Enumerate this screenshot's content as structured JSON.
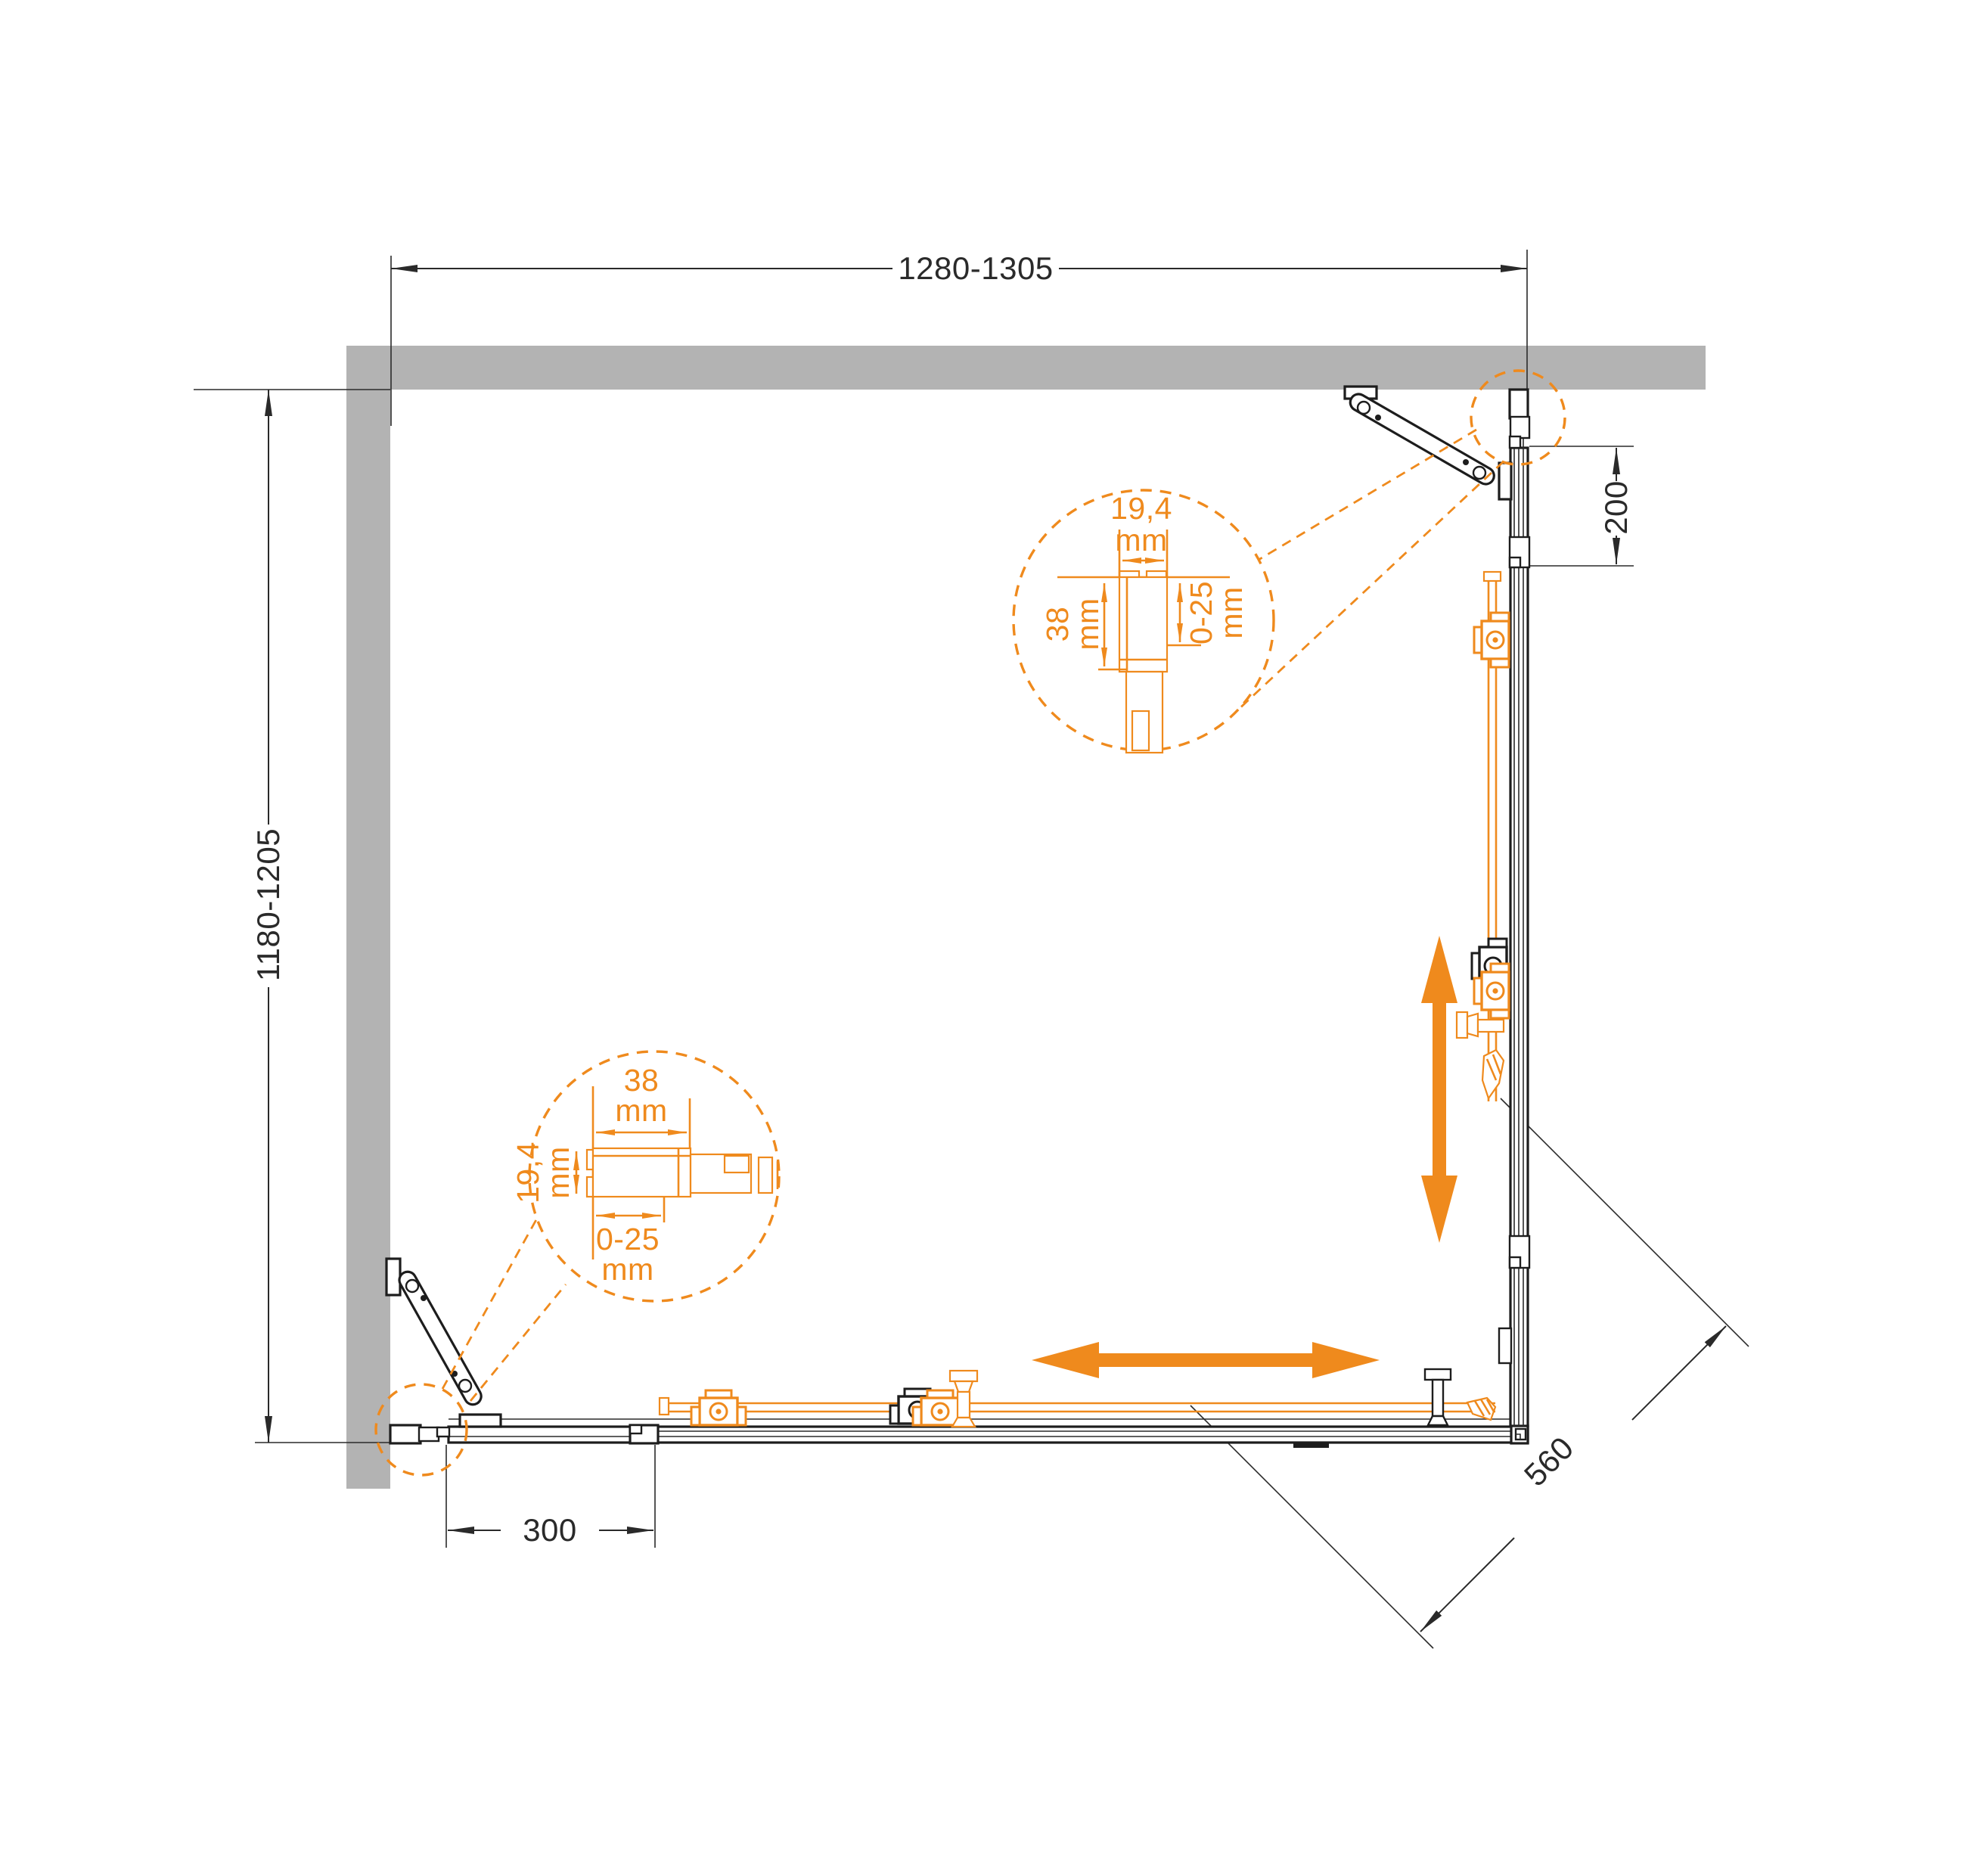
{
  "drawing": {
    "type": "shower-enclosure-installation-plan",
    "colors": {
      "wall": "#b3b3b3",
      "line": "#2a2a2a",
      "accent": "#ef8a1d",
      "background": "#ffffff"
    },
    "dimensions": {
      "width": "1280-1305",
      "depth": "1180-1205",
      "right_offset": "200",
      "bottom_offset": "300",
      "diagonal_entry": "560"
    },
    "detail_top_profile": {
      "width": "19,4",
      "width_unit": "mm",
      "depth": "38",
      "depth_unit": "mm",
      "adjustment": "0-25",
      "adjustment_unit": "mm"
    },
    "detail_side_profile": {
      "width": "38",
      "width_unit": "mm",
      "depth": "19,4",
      "depth_unit": "mm",
      "adjustment": "0-25",
      "adjustment_unit": "mm"
    }
  }
}
